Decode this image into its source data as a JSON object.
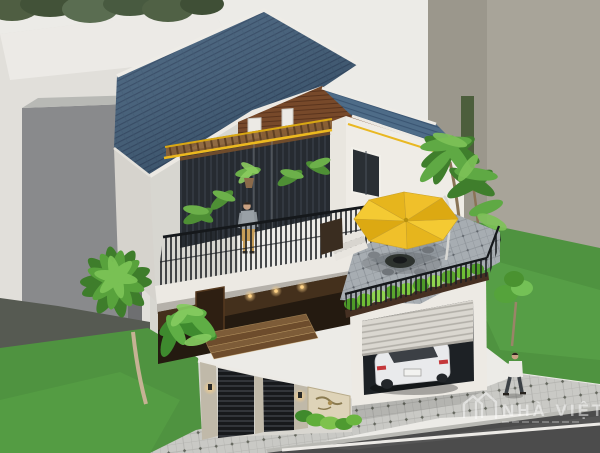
{
  "meta": {
    "type": "3d-architectural-exterior-render",
    "subject": "modern two-story villa, aerial three-quarter view",
    "canvas": {
      "width": 600,
      "height": 453
    }
  },
  "palette": {
    "sky": "#ecebe7",
    "roof_tile_blue": "#3c5a77",
    "roof_tile_light": "#4e6c88",
    "ridge_white": "#eeece7",
    "gable_wood": "#77492a",
    "wall_white": "#f0ede7",
    "wall_shadow": "#d6d3cd",
    "glass_dark": "#262b31",
    "accent_yellow": "#e9b822",
    "umbrella_yellow": "#f0c22a",
    "railing_black": "#1c1f23",
    "plant_green": "#4e8f3a",
    "lawn_green": "#4f9340",
    "sidewalk_gray": "#c9c9c5",
    "road_asphalt": "#4c4c4c",
    "car_white": "#e9eaeb",
    "door_wood": "#3a2a1c",
    "stone_mural": "#ded3b8",
    "warm_light": "#ffd387",
    "bg_building_gray": "#898a8c",
    "bg_building_beige": "#a8a499"
  },
  "scene": {
    "setting": "suburban corner lot flanked by plain gray block buildings, green lawns, paved sidewalk and asphalt road",
    "house": {
      "style": "modern two-story villa",
      "roof": {
        "type": "gable",
        "material": "ribbed tiles",
        "color": "slate blue",
        "trim": "white ridge capping"
      },
      "gable": {
        "cladding": "brown horizontal wood planks",
        "small_white_windows": 2
      },
      "second_floor": {
        "balcony": {
          "railing": "black vertical metal bars on white slab",
          "plants": "potted tropical palms",
          "awning": "yellow pergola beams with wood rafters"
        },
        "glazing": "full-height dark slatted glass wall"
      },
      "right_wing": {
        "window": "dark glass, white frame",
        "roof_terrace": {
          "floor": "gray stone paving",
          "umbrella": "yellow cantilever parasol",
          "furniture": "round table with chairs",
          "railing": "black metal with green planter border",
          "steps": "white steps from house"
        }
      },
      "ground_floor": {
        "entry": "dark wood door wall with warm downlights",
        "steps": "four wide wood-stone steps"
      },
      "garage": {
        "door": "white roller shutter half open",
        "vehicle": "white sedan parked inside"
      },
      "fence": {
        "gates": "black horizontal-slat panels",
        "pillars": "speckled stone with warm lamps",
        "feature": "beige koi-mural stone panel with shrubs"
      }
    },
    "figures": [
      {
        "id": "man-on-balcony",
        "clothing": "gray t-shirt, khaki trousers",
        "pose": "standing at railing"
      },
      {
        "id": "man-on-sidewalk",
        "clothing": "white shirt, dark trousers",
        "pose": "walking"
      }
    ],
    "vegetation": [
      "fan palm on left lawn",
      "tropical shrubs at front-left house corner",
      "tall palms beside roof terrace",
      "small tree by right sidewalk",
      "overhanging canopy foliage, top-left corner"
    ],
    "street": {
      "sidewalk": "diamond-pattern pavers",
      "road": "asphalt with white edge line"
    },
    "watermark": {
      "logo": "double-house-outline-icon",
      "text": "NHÀ VIỆT",
      "style": "semi-transparent white, bottom right"
    }
  }
}
